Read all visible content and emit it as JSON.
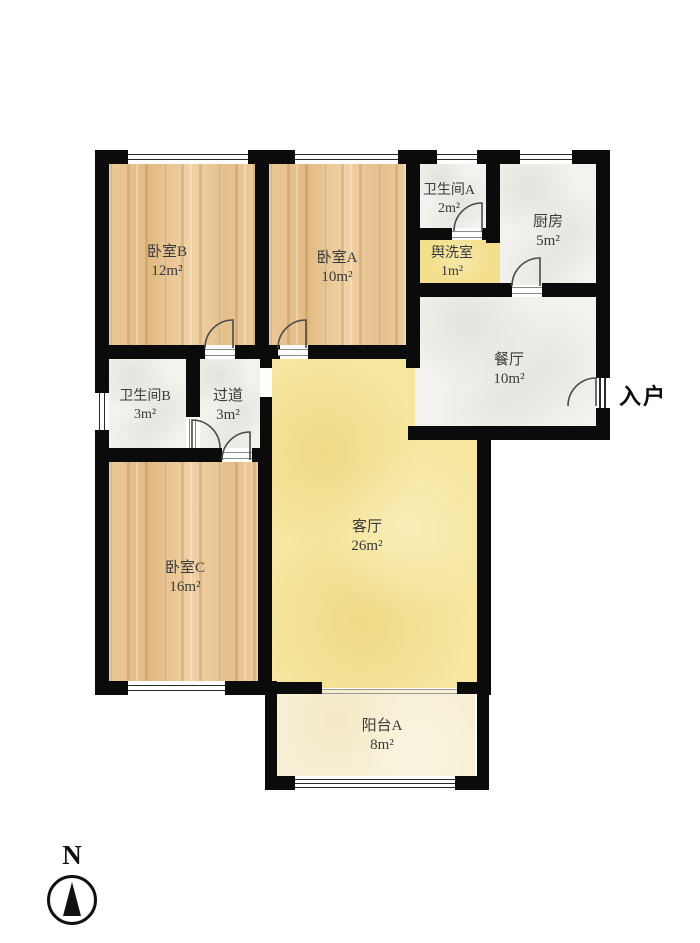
{
  "plan": {
    "rooms": {
      "bedroom_b": {
        "name": "卧室B",
        "area": "12m²"
      },
      "bedroom_a": {
        "name": "卧室A",
        "area": "10m²"
      },
      "bathroom_a": {
        "name": "卫生间A",
        "area": "2m²"
      },
      "kitchen": {
        "name": "厨房",
        "area": "5m²"
      },
      "washroom": {
        "name": "舆洗室",
        "area": "1m²"
      },
      "dining": {
        "name": "餐厅",
        "area": "10m²"
      },
      "bathroom_b": {
        "name": "卫生间B",
        "area": "3m²"
      },
      "corridor": {
        "name": "过道",
        "area": "3m²"
      },
      "living": {
        "name": "客厅",
        "area": "26m²"
      },
      "bedroom_c": {
        "name": "卧室C",
        "area": "16m²"
      },
      "balcony": {
        "name": "阳台A",
        "area": "8m²"
      }
    },
    "entrance_label": "入户",
    "compass_label": "N",
    "colors": {
      "wall": "#0b0b0b",
      "wood_floor": "#e9c697",
      "tile_floor": "#f3f2ee",
      "living_floor": "#f6e6a0",
      "washroom_floor": "#f3df8e",
      "balcony_floor": "#f7f0d6",
      "label_text": "#3b3b3b"
    }
  }
}
